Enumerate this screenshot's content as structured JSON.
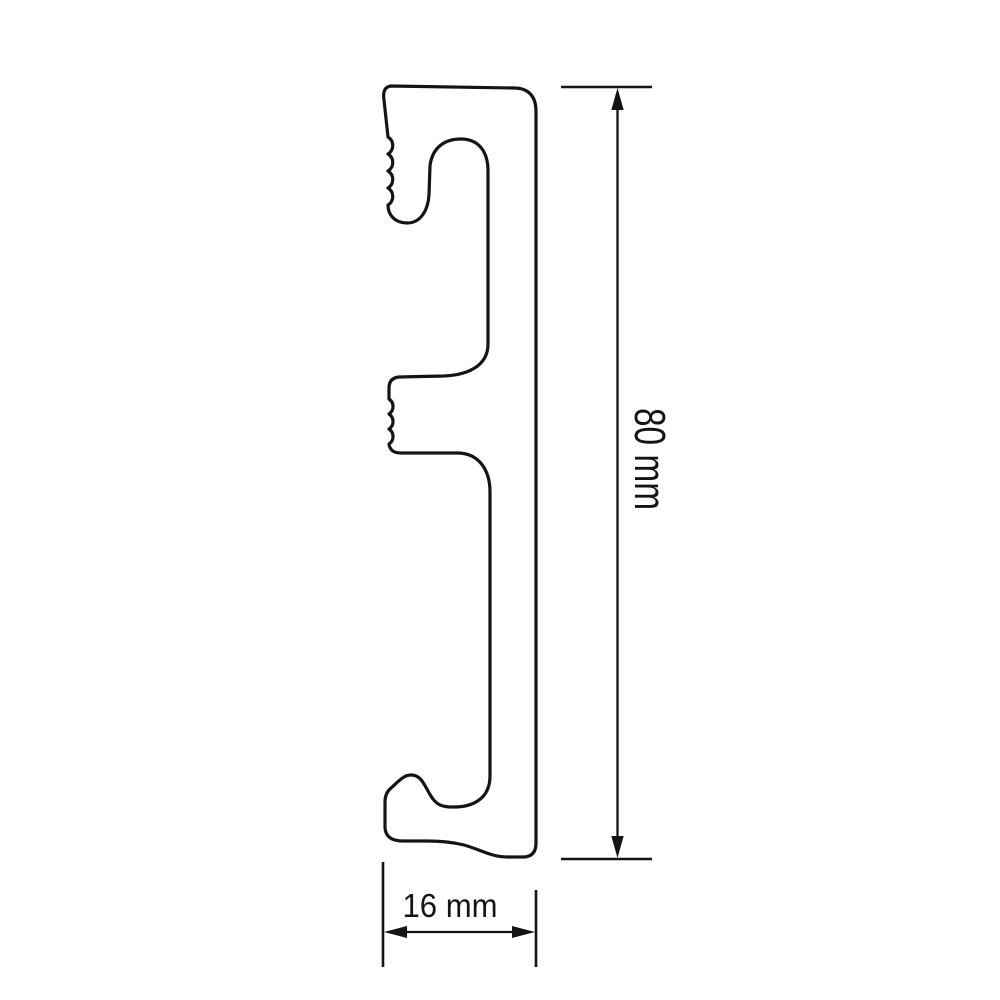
{
  "drawing": {
    "background_color": "#ffffff",
    "line_color": "#141414",
    "dimensions": {
      "height": {
        "label": "80 mm"
      },
      "width": {
        "label": "16 mm"
      }
    }
  }
}
